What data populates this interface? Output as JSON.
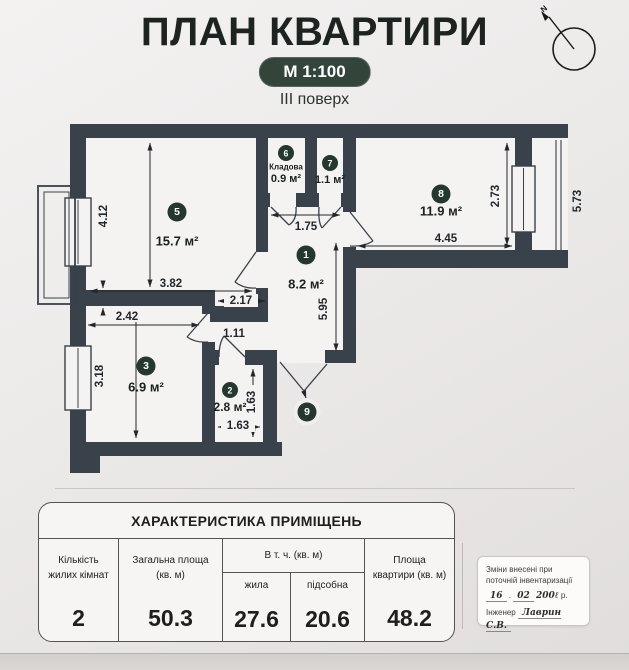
{
  "header": {
    "title": "ПЛАН КВАРТИРИ",
    "scale": "М 1:100",
    "floor": "ІІІ поверх"
  },
  "compass": {
    "n": "N"
  },
  "colors": {
    "wall": "#39414b",
    "floor": "#f5f3f1",
    "badge_green": "#24382e",
    "pill_green": "#33453b"
  },
  "plan": {
    "badges": [
      {
        "n": "5",
        "x": 177,
        "y": 212,
        "r": 9.5
      },
      {
        "n": "6",
        "x": 286,
        "y": 153,
        "r": 8
      },
      {
        "n": "7",
        "x": 330,
        "y": 163,
        "r": 8
      },
      {
        "n": "1",
        "x": 306,
        "y": 255,
        "r": 9.5
      },
      {
        "n": "3",
        "x": 146,
        "y": 366,
        "r": 9.5
      },
      {
        "n": "2",
        "x": 230,
        "y": 390,
        "r": 8
      },
      {
        "n": "8",
        "x": 441,
        "y": 194,
        "r": 9.5
      },
      {
        "n": "9",
        "x": 307,
        "y": 412,
        "r": 9.5,
        "ring": true
      }
    ],
    "labels": [
      {
        "t": "15.7 м²",
        "x": 177,
        "y": 241,
        "s": 13,
        "w": 700,
        "cls": "area"
      },
      {
        "t": "Кладова",
        "x": 286,
        "y": 167,
        "s": 8,
        "w": 600,
        "cls": "area"
      },
      {
        "t": "0.9 м²",
        "x": 286,
        "y": 179,
        "s": 11,
        "w": 700,
        "cls": "area"
      },
      {
        "t": "1.1 м²",
        "x": 330,
        "y": 180,
        "s": 11,
        "w": 700,
        "cls": "area"
      },
      {
        "t": "8.2 м²",
        "x": 306,
        "y": 284,
        "s": 13,
        "w": 700,
        "cls": "area"
      },
      {
        "t": "6.9 м²",
        "x": 146,
        "y": 387,
        "s": 13,
        "w": 700,
        "cls": "area"
      },
      {
        "t": "2.8 м²",
        "x": 230,
        "y": 407,
        "s": 12,
        "w": 700,
        "cls": "area"
      },
      {
        "t": "11.9 м²",
        "x": 441,
        "y": 211,
        "s": 13,
        "w": 700,
        "cls": "area"
      },
      {
        "t": "4.12",
        "x": 104,
        "y": 216,
        "s": 11.5,
        "rot": -90,
        "cls": "dim"
      },
      {
        "t": "3.82",
        "x": 171,
        "y": 284,
        "s": 11.5,
        "cls": "dim"
      },
      {
        "t": "2.17",
        "x": 241,
        "y": 301,
        "s": 11.5,
        "cls": "dim",
        "bg": [
          224,
          294,
          34,
          13
        ]
      },
      {
        "t": "1.75",
        "x": 306,
        "y": 227,
        "s": 11.5,
        "cls": "dim"
      },
      {
        "t": "5.95",
        "x": 324,
        "y": 309,
        "s": 11.5,
        "rot": -90,
        "cls": "dim"
      },
      {
        "t": "2.42",
        "x": 127,
        "y": 317,
        "s": 11.5,
        "cls": "dim",
        "bg": [
          110,
          310,
          34,
          12
        ]
      },
      {
        "t": "3.18",
        "x": 100,
        "y": 376,
        "s": 11.5,
        "rot": -90,
        "cls": "dim"
      },
      {
        "t": "1.11",
        "x": 234,
        "y": 334,
        "s": 11.5,
        "cls": "dim"
      },
      {
        "t": "1.63",
        "x": 238,
        "y": 426,
        "s": 11.5,
        "cls": "dim",
        "bg": [
          221,
          420,
          34,
          12
        ]
      },
      {
        "t": "1.63",
        "x": 252,
        "y": 402,
        "s": 11.5,
        "rot": -90,
        "cls": "dim",
        "bg": [
          246,
          385,
          13,
          35
        ]
      },
      {
        "t": "4.45",
        "x": 446,
        "y": 239,
        "s": 11.5,
        "cls": "dim"
      },
      {
        "t": "2.73",
        "x": 496,
        "y": 196,
        "s": 11.5,
        "rot": -90,
        "cls": "dim"
      },
      {
        "t": "5.73",
        "x": 578,
        "y": 201,
        "s": 11.5,
        "rot": -90,
        "cls": "dim"
      }
    ]
  },
  "table": {
    "title": "ХАРАКТЕРИСТИКА ПРИМІЩЕНЬ",
    "columns": [
      {
        "label": "Кількість жилих кімнат"
      },
      {
        "label": "Загальна площа (кв. м)"
      },
      {
        "label": "В т. ч. (кв. м)",
        "sub": [
          "жила",
          "підсобна"
        ]
      },
      {
        "label": "Площа квартири (кв. м)"
      }
    ],
    "values": [
      "2",
      "50.3",
      "27.6",
      "20.6",
      "48.2"
    ]
  },
  "stamp": {
    "line1": "Зміни внесені при",
    "line2": "поточній інвентаризації",
    "day": "16",
    "sep": ".",
    "month": "02",
    "year": "200ℓ",
    "year_suffix": "р.",
    "engineer_label": "Інженер",
    "engineer_name": "Лаврин С.В."
  }
}
